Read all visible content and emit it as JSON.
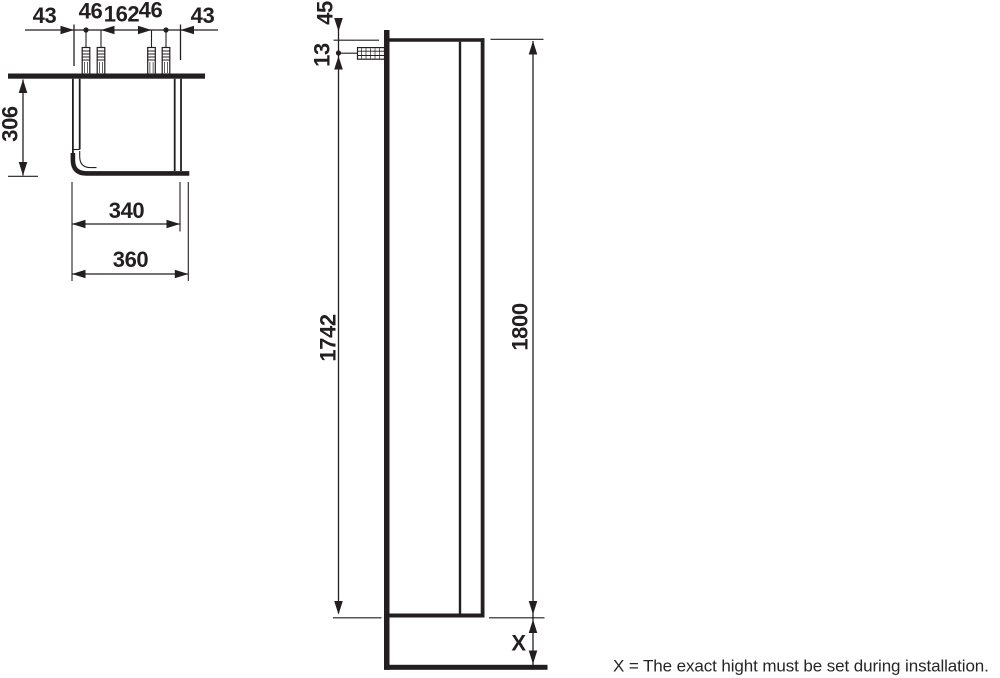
{
  "drawing": {
    "note": "X = The exact hight must be set during installation.",
    "colors": {
      "line": "#231f20",
      "background": "#ffffff"
    },
    "top_view": {
      "dims": {
        "edge_left": "43",
        "pair_left": "46",
        "center": "162",
        "pair_right": "46",
        "edge_right": "43",
        "depth": "306",
        "inner_width": "340",
        "outer_width": "360"
      }
    },
    "side_view": {
      "dims": {
        "wall_top_offset": "45",
        "screw_offset": "13",
        "screw_to_bottom": "1742",
        "height": "1800",
        "floor_gap": "X"
      }
    }
  }
}
